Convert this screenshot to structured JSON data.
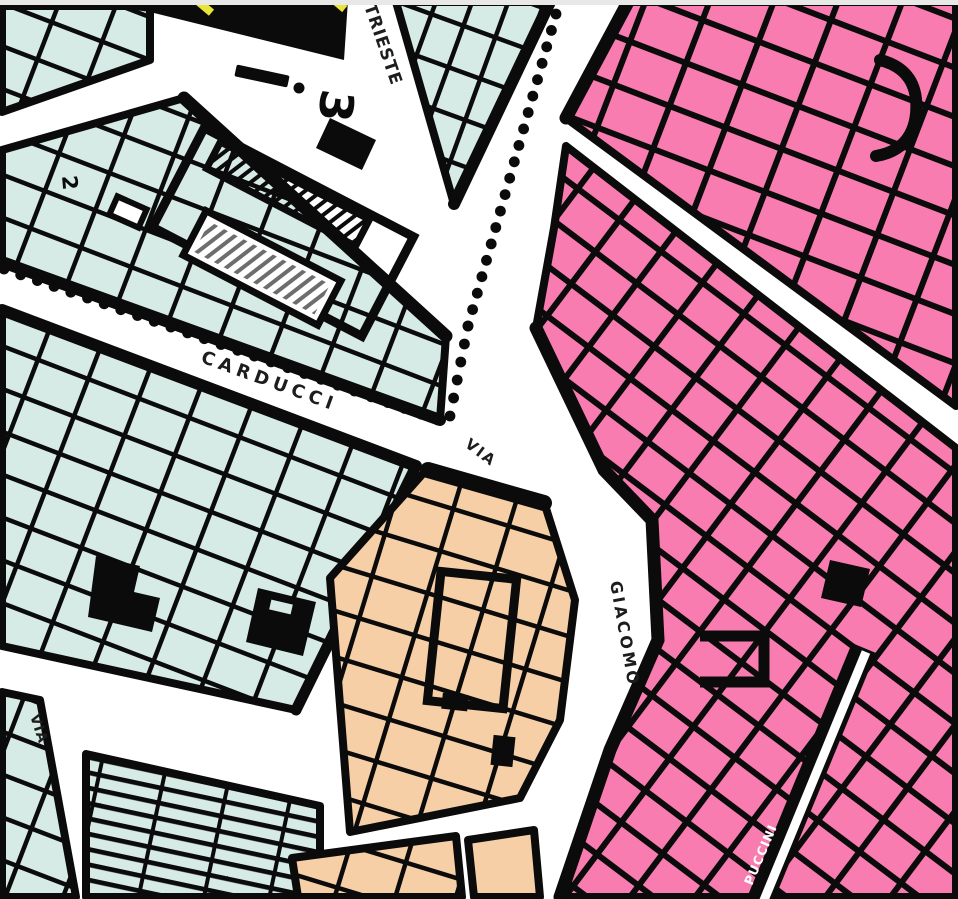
{
  "app": {
    "description": "Scanned urban zoning plan (piano regolatore) map crop with colored building zones, parcel grids, street names and a dotted zone boundary"
  },
  "map": {
    "canvas": {
      "width_px": 958,
      "height_px": 899
    },
    "colors": {
      "background": "#ffffff",
      "zone_mint": "#d6eae6",
      "zone_pink": "#f97cb0",
      "zone_peach": "#f6cfa6",
      "line_black": "#0b0b0b",
      "highlight_yellow": "#e8e438",
      "top_strip_gray": "#e8e8e6",
      "street_white": "#ffffff",
      "label_dark": "#1d1d1d",
      "label_white": "#ffffff"
    },
    "labels": {
      "street_via": "VIA",
      "street_giacomo": "GIACOMO",
      "street_top_vertical_fragment": "TRIESTE",
      "street_dotted_diagonal": "CARDUCCI",
      "street_bottom_right": "PUCCINI",
      "street_via_small": "VIA",
      "zone_number_large": "3",
      "zone_number_small": "2"
    },
    "symbols": {
      "section_dash": "section line dash",
      "zoning_boundary": "black dotted chain marking zone boundary",
      "hatched_building": "diagonally hatched slab building",
      "solid_black_block": "black filled block with yellow boundary dashes"
    },
    "dotted_boundaries": [
      {
        "points": [
          [
            4,
            269
          ],
          [
            438,
            420
          ]
        ],
        "spacing_px": 17.5,
        "dot_radius_px": 5.4
      },
      {
        "points": [
          [
            556,
            14
          ],
          [
            468,
            326
          ],
          [
            450,
            416
          ]
        ],
        "spacing_px": 17.5,
        "dot_radius_px": 5.4
      }
    ]
  }
}
